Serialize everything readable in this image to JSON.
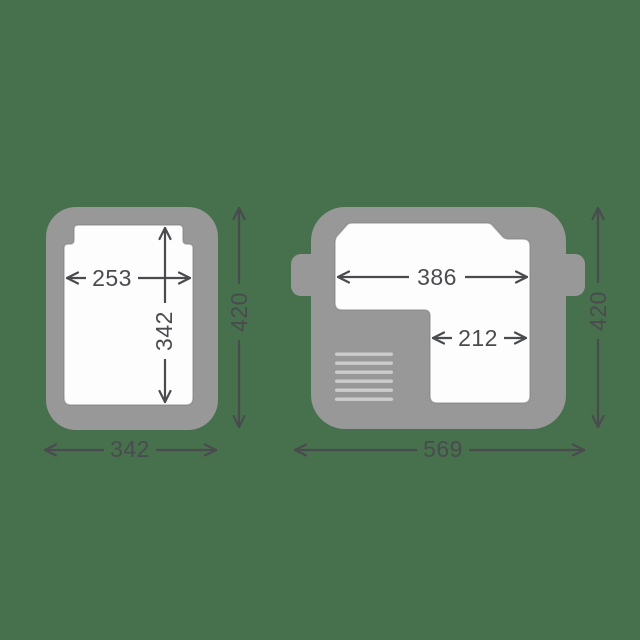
{
  "colors": {
    "background": "#47704D",
    "unit_body": "#989898",
    "cavity": "#FDFDFD",
    "vent": "#CCCCCC",
    "dimension": "#4A4B4F"
  },
  "left_unit": {
    "inner_width": "253",
    "inner_depth": "342",
    "outer_depth": "420",
    "outer_width": "342"
  },
  "right_unit": {
    "main_compartment_width": "386",
    "side_compartment_width": "212",
    "outer_depth": "420",
    "outer_width": "569"
  }
}
